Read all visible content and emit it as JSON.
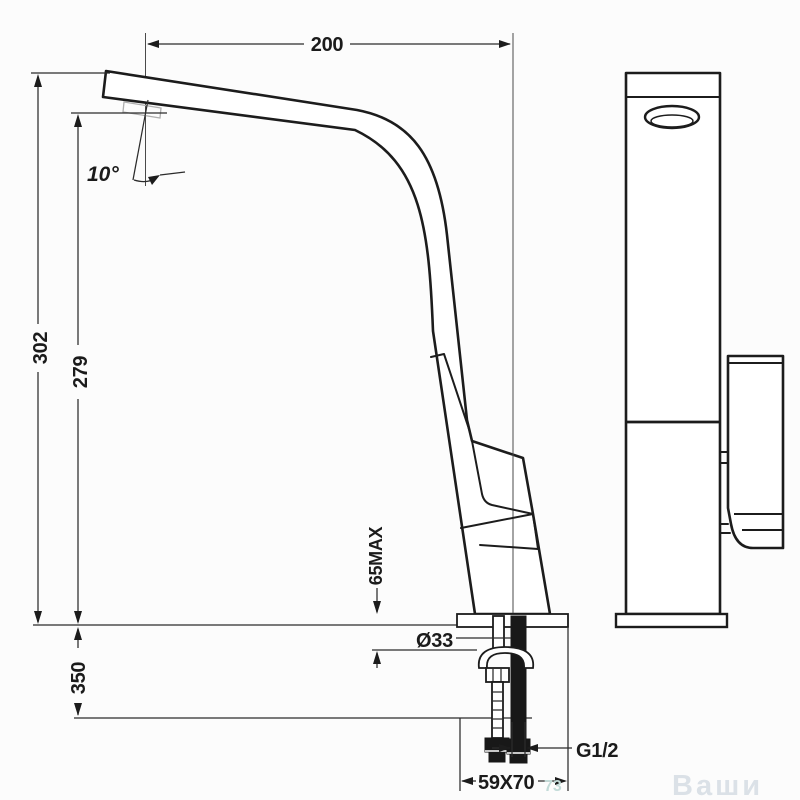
{
  "drawing": {
    "kind": "faucet-dimensional-diagram",
    "background": "#fcfcfc",
    "line_color": "#1c1c1c"
  },
  "labels": {
    "spout_reach": "200",
    "total_height": "302",
    "spout_height": "279",
    "below_counter": "350",
    "counter_max": "65MAX",
    "hole_diameter": "Ø33",
    "thread": "G1/2",
    "base_size": "59X70",
    "angle": "10°"
  },
  "watermark": {
    "text": "Ваши",
    "mark": "73"
  }
}
